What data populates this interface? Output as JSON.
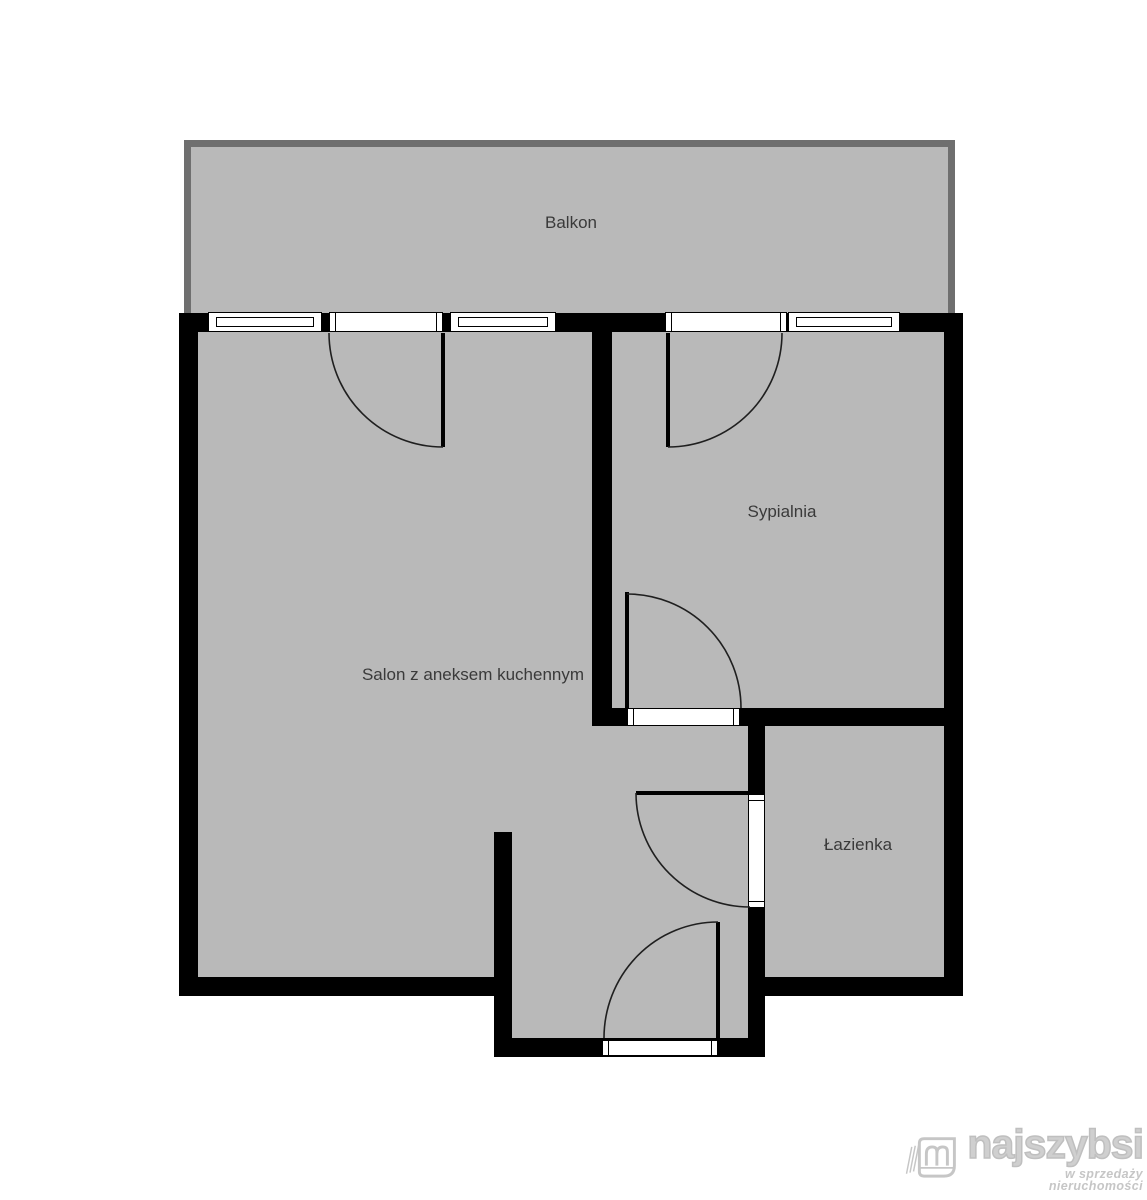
{
  "plan": {
    "rooms": [
      {
        "id": "balcony",
        "label": "Balkon"
      },
      {
        "id": "living",
        "label": "Salon z aneksem kuchennym"
      },
      {
        "id": "bedroom",
        "label": "Sypialnia"
      },
      {
        "id": "bathroom",
        "label": "Łazienka"
      }
    ]
  },
  "watermark": {
    "brand": "najszybsi",
    "tagline": "w sprzedaży nieruchomości"
  },
  "colors": {
    "floor": "#b9b9b9",
    "wall": "#000000",
    "balcony-border": "#6f6f6f",
    "label": "#3a3a3a",
    "door-line": "#1f1f1f",
    "watermark": "#c6c6c6",
    "bg": "#ffffff"
  }
}
